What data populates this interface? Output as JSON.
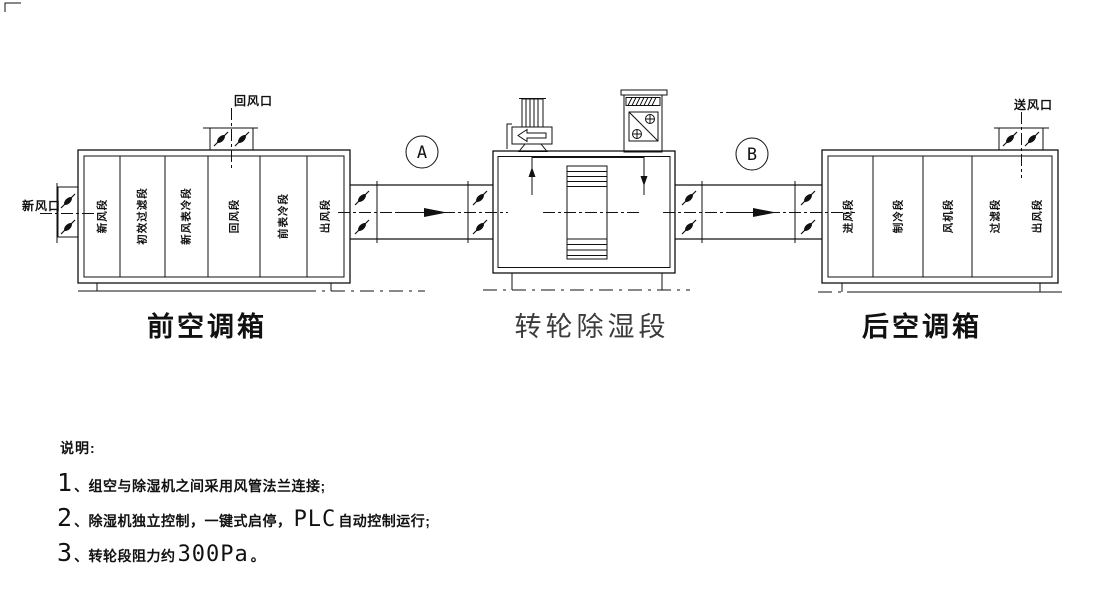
{
  "front_ahu": {
    "title": "前空调箱",
    "sections": [
      "新风段",
      "初效过滤段",
      "新风表冷段",
      "回风段",
      "前表冷段",
      "出风段"
    ],
    "fresh_air_inlet": "新风口",
    "return_air_inlet": "回风口"
  },
  "dehumidifier": {
    "title": "转轮除湿段",
    "duct_a": "A",
    "duct_b": "B"
  },
  "rear_ahu": {
    "title": "后空调箱",
    "sections": [
      "进风段",
      "制冷段",
      "风机段",
      "过滤段",
      "出风段"
    ],
    "supply_outlet": "送风口"
  },
  "notes": {
    "heading": "说明:",
    "items": [
      {
        "num": "1",
        "text": "、组空与除湿机之间采用风管法兰连接;",
        "big": "",
        "text2": ""
      },
      {
        "num": "2",
        "text": "、除湿机独立控制，一键式启停，",
        "big": "PLC",
        "text2": " 自动控制运行;"
      },
      {
        "num": "3",
        "text": "、转轮段阻力约",
        "big": "300Pa",
        "text2": "。"
      }
    ]
  },
  "colors": {
    "line": "#111111",
    "background": "#ffffff"
  }
}
